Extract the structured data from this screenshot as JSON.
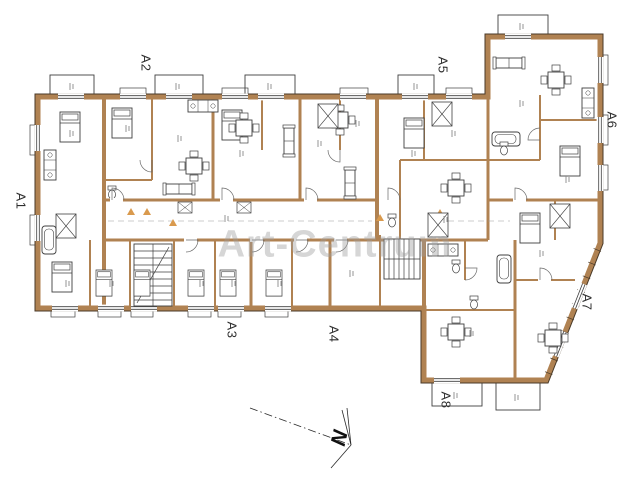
{
  "plan": {
    "watermark": "Art-Centrum",
    "compass_label": "N",
    "units": [
      {
        "label": "A1"
      },
      {
        "label": "A2"
      },
      {
        "label": "A3"
      },
      {
        "label": "A4"
      },
      {
        "label": "A5"
      },
      {
        "label": "A6"
      },
      {
        "label": "A7"
      },
      {
        "label": "A8"
      }
    ]
  },
  "colors": {
    "wall": "#b08252",
    "wall_edge": "#4a3a28",
    "detail_line": "#3f3f3f",
    "annotation": "#8a8a8a",
    "entry_marker": "#d99a4e",
    "watermark": "#9e9e9e"
  }
}
